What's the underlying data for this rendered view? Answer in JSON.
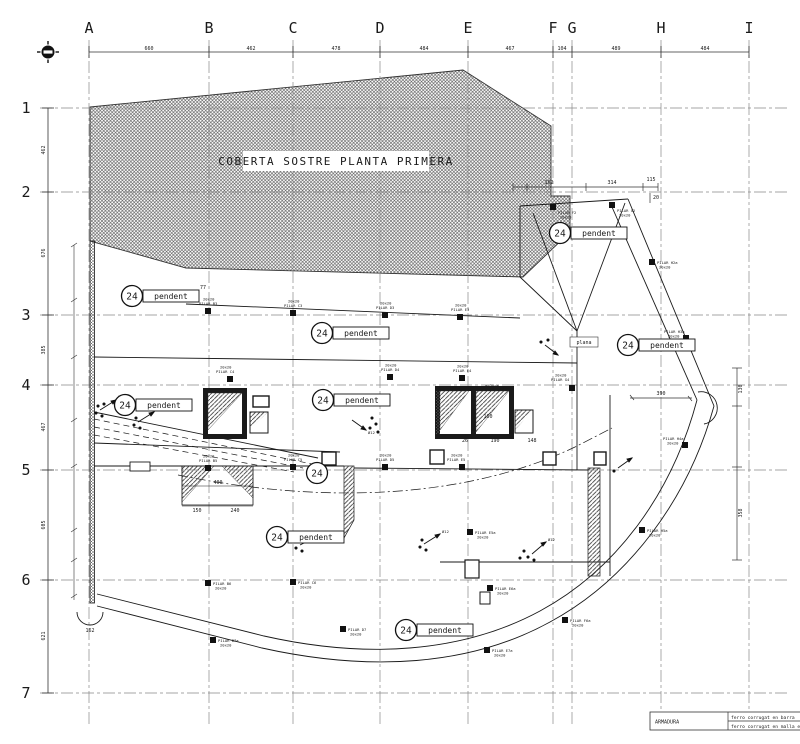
{
  "title": "COBERTA SOSTRE PLANTA PRIMERA",
  "colors": {
    "ink": "#1a1a1a",
    "grid": "#888888",
    "paper": "#ffffff",
    "hatch": "#444444"
  },
  "grid": {
    "cols": [
      {
        "label": "A"
      },
      {
        "label": "B"
      },
      {
        "label": "C"
      },
      {
        "label": "D"
      },
      {
        "label": "E"
      },
      {
        "label": "F"
      },
      {
        "label": "G"
      },
      {
        "label": "H"
      },
      {
        "label": "I"
      }
    ],
    "rows": [
      {
        "label": "1"
      },
      {
        "label": "2"
      },
      {
        "label": "3"
      },
      {
        "label": "4"
      },
      {
        "label": "5"
      },
      {
        "label": "6"
      },
      {
        "label": "7"
      }
    ]
  },
  "dims": {
    "top": [
      "660",
      "462",
      "478",
      "484",
      "467",
      "104",
      "489",
      "484"
    ],
    "left": [
      "462",
      "676",
      "385",
      "467",
      "605",
      "621"
    ],
    "upper_right": [
      "162",
      "314",
      "115",
      "20"
    ],
    "right": [
      "130",
      "358"
    ],
    "shaft": [
      "26",
      "190",
      "148"
    ],
    "beam": [
      "150",
      "400",
      "240"
    ],
    "point": "390",
    "corner": "162",
    "opening": "160",
    "thickness": "e=20cm",
    "misc": "77"
  },
  "pendent": {
    "number": "24",
    "label": "pendent"
  },
  "plana": "plana",
  "rebar": "Ø12",
  "pilars": [
    {
      "name": "PILAR F2",
      "size": "20x20"
    },
    {
      "name": "PILAR G2",
      "size": "20x20"
    },
    {
      "name": "PILAR H2a",
      "size": "20x20"
    },
    {
      "name": "PILAR H3a",
      "size": "20x20"
    },
    {
      "name": "PILAR B3",
      "size": "20x20"
    },
    {
      "name": "PILAR C3",
      "size": "20x20"
    },
    {
      "name": "PILAR D3",
      "size": "20x20"
    },
    {
      "name": "PILAR E3",
      "size": "20x20"
    },
    {
      "name": "PILAR C4",
      "size": "20x20"
    },
    {
      "name": "PILAR D4",
      "size": "20x20"
    },
    {
      "name": "PILAR E4",
      "size": "20x20"
    },
    {
      "name": "PILAR G4",
      "size": "20x20"
    },
    {
      "name": "PILAR H4a",
      "size": "20x20"
    },
    {
      "name": "PILAR B5",
      "size": "20x20"
    },
    {
      "name": "PILAR C5",
      "size": "20x20"
    },
    {
      "name": "PILAR D5",
      "size": "20x20"
    },
    {
      "name": "PILAR E5",
      "size": "20x20"
    },
    {
      "name": "PILAR E5a",
      "size": "20x20"
    },
    {
      "name": "PILAR B6",
      "size": "20x20"
    },
    {
      "name": "PILAR C6",
      "size": "20x20"
    },
    {
      "name": "PILAR E6a",
      "size": "20x20"
    },
    {
      "name": "PILAR F6a",
      "size": "20x20"
    },
    {
      "name": "PILAR H5a",
      "size": "20x20"
    },
    {
      "name": "PILAR D7",
      "size": "20x20"
    },
    {
      "name": "PILAR E7a",
      "size": "20x20"
    },
    {
      "name": "PILAR B7a",
      "size": "20x20"
    }
  ],
  "legend": {
    "title": "ARMADURA",
    "row1": "ferro corrugat en barra",
    "row2": "ferro corrugat en malla electrosoldada"
  }
}
